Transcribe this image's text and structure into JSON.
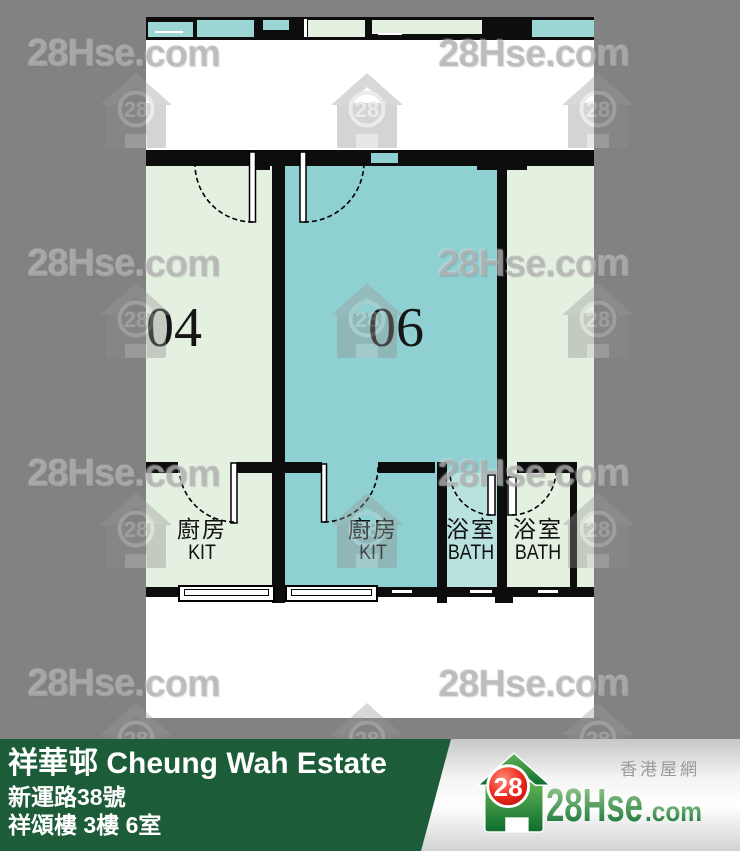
{
  "watermark": {
    "text": "28Hse.com",
    "badge": "28"
  },
  "floor_plan": {
    "unit_left": "04",
    "unit_middle": "06",
    "kitchen_zh": "廚房",
    "kitchen_en": "KIT",
    "bath_zh": "浴室",
    "bath_en": "BATH"
  },
  "footer": {
    "estate_title": "祥華邨 Cheung Wah Estate",
    "address": "新運路38號",
    "flat": "祥頌樓 3樓 6室",
    "site_name_zh": "香港屋網",
    "logo_badge": "28",
    "logo_name": "28Hse",
    "logo_tld": ".com"
  },
  "colors": {
    "background_gray": "#828282",
    "plan_white": "#ffffff",
    "wall_black": "#0d0d0d",
    "room_pale_green": "#e4f0e0",
    "room_teal": "#8fd0d2",
    "bath_teal": "#b9e2de",
    "strip_teal": "#9cd6d4",
    "footer_green": "#1d5c38",
    "brand_green_light": "#a6d398",
    "brand_green_dark": "#0c6e31",
    "brand_red": "#d41414"
  }
}
